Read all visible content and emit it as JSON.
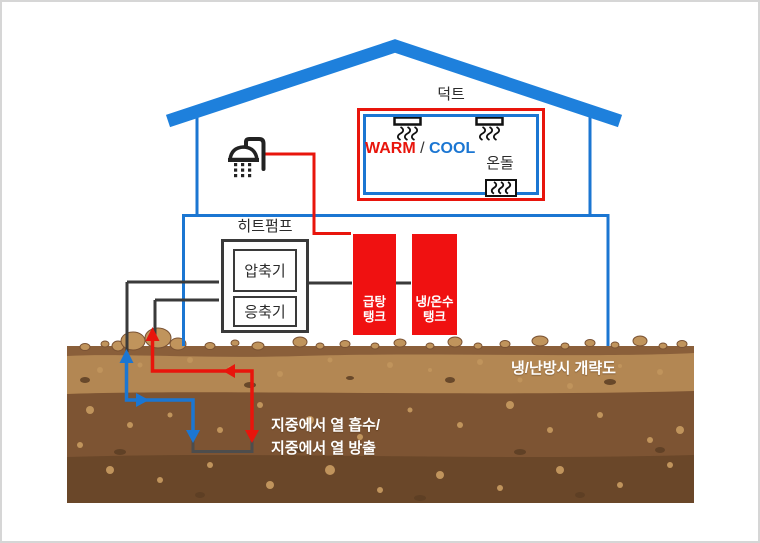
{
  "labels": {
    "duct": "덕트",
    "warm": "WARM",
    "slash": " / ",
    "cool": "COOL",
    "ondol": "온돌",
    "heat_pump": "히트펌프",
    "compressor": "압축기",
    "condenser": "응축기",
    "hot_water_tank": {
      "line1": "급탕",
      "line2": "탱크"
    },
    "cold_hot_water_tank": {
      "line1": "냉/온수",
      "line2": "탱크"
    },
    "caption": "냉/난방시 개략도",
    "ground_note_line1": "지중에서 열 흡수/",
    "ground_note_line2": "지중에서 열 방출"
  },
  "colors": {
    "blue": "#1b76d2",
    "roof_blue": "#1e80dc",
    "red": "#e8150c",
    "tank_red": "#f01111",
    "dark": "#3a3a3a",
    "pipe_dark": "#4d4d4d",
    "soil_strip": "#8a5f3a",
    "soil_light": "#b38753",
    "soil_mid": "#7d5433",
    "soil_dark": "#6a4729",
    "rock": "#c0945c",
    "rock_dark": "#5c3e24"
  }
}
